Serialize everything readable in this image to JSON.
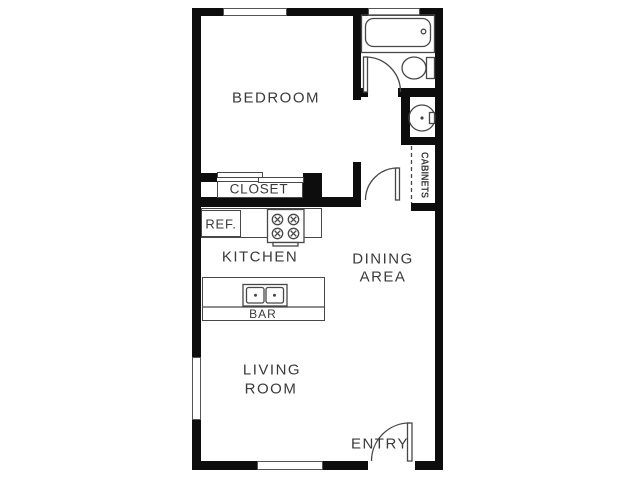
{
  "rooms": {
    "bedroom": {
      "label": "BEDROOM"
    },
    "closet": {
      "label": "CLOSET"
    },
    "kitchen": {
      "label": "KITCHEN"
    },
    "dining_area": {
      "lines": [
        "DINING",
        "AREA"
      ]
    },
    "living_room": {
      "lines": [
        "LIVING",
        "ROOM"
      ]
    },
    "entry": {
      "label": "ENTRY"
    },
    "bar": {
      "label": "BAR"
    },
    "cabinets": {
      "label": "CABINETS"
    },
    "refrigerator": {
      "label": "REF."
    }
  },
  "icons": {
    "bathtub": "bathtub-icon",
    "toilet": "toilet-icon",
    "bathroom_sink": "round-sink-icon",
    "stove": "four-burner-stove-icon",
    "bar_sink": "double-basin-sink-icon",
    "closet_doors": "sliding-door-panels-icon",
    "doors": [
      "bathroom-door-swing-icon",
      "hall-door-swing-icon",
      "entry-door-swing-icon"
    ],
    "windows": [
      "bedroom-top-window",
      "bathroom-top-window",
      "living-left-window",
      "living-bottom-window"
    ],
    "cabinet_line": "dashed-cabinet-line"
  },
  "colors": {
    "background": "#ffffff",
    "wall": "#0d0d0d",
    "line": "#474747",
    "text": "#3a3a3a"
  }
}
